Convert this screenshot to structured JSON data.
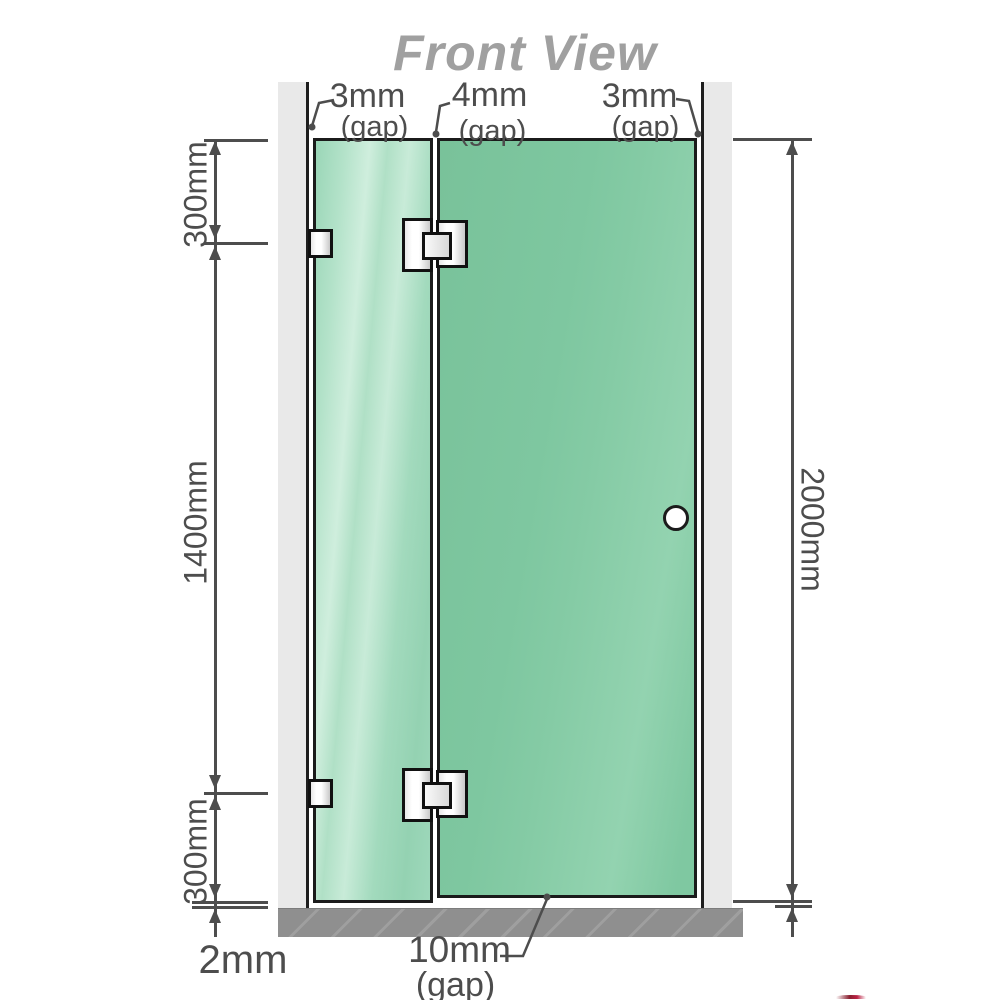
{
  "title": "Front View",
  "annotations": {
    "gap_top_left": {
      "value": "3mm",
      "suffix": "(gap)"
    },
    "gap_top_middle": {
      "value": "4mm",
      "suffix": "(gap)"
    },
    "gap_top_right": {
      "value": "3mm",
      "suffix": "(gap)"
    },
    "gap_bottom": {
      "value": "10mm",
      "suffix": "(gap)"
    },
    "segment_top": "300mm",
    "segment_middle": "1400mm",
    "segment_bottom": "300mm",
    "floor_gap": "2mm",
    "total_height": "2000mm"
  },
  "colors": {
    "glass_door": "#7fc7a0",
    "glass_fixed": "#a9dfc4",
    "wall": "#e9e9e9",
    "floor": "#8f8f8f",
    "dimension_lines": "#4d4d4d",
    "title_text": "#a0a0a0",
    "outline": "#1b1b1b",
    "hardware": "#f2f2f2"
  }
}
